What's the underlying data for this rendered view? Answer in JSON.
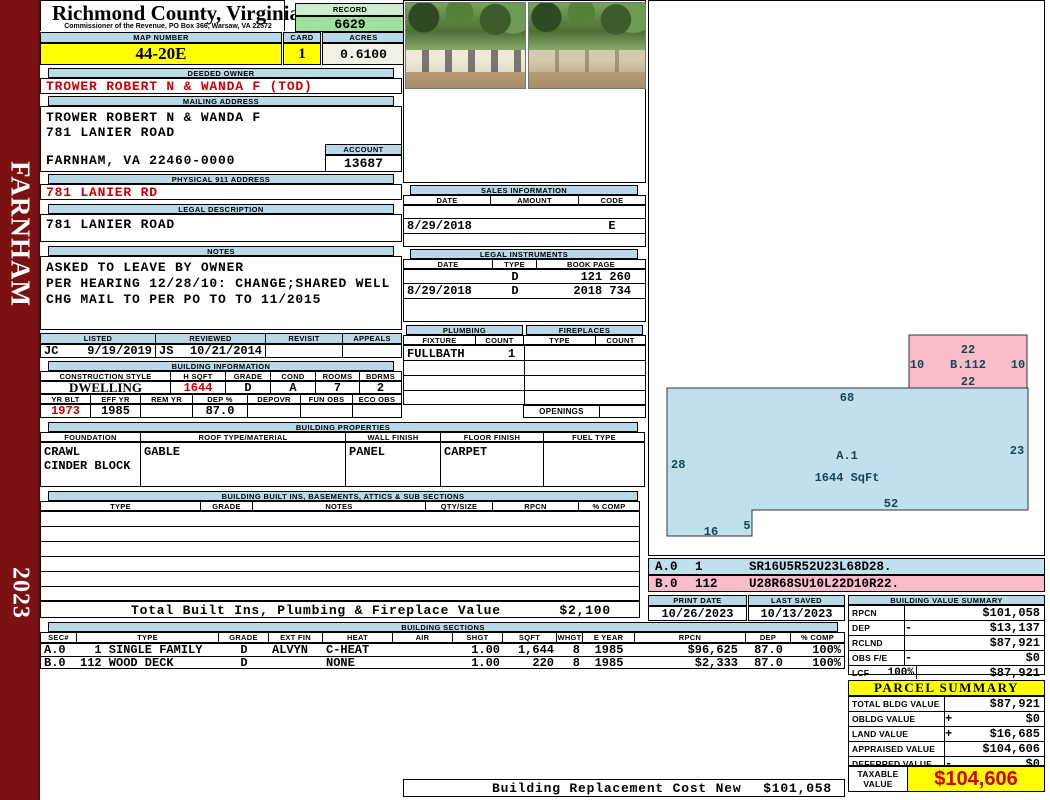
{
  "colors": {
    "blue": "#b9d9e8",
    "yellow": "#ffff00",
    "green": "#9fe09f",
    "green_light": "#cdeccd",
    "maroon": "#7c1113",
    "pink": "#f9bdc9",
    "sketch_blue": "#bfe0ec",
    "red": "#cc0000",
    "cream": "#f1f0e2"
  },
  "sidebar": {
    "district": "FARNHAM",
    "year": "2023"
  },
  "header": {
    "county": "Richmond County, Virginia",
    "subtitle": "Commissioner of the Revenue, PO Box 366, Warsaw, VA 22572",
    "record_label": "RECORD",
    "record_value": "6629",
    "map_label": "MAP NUMBER",
    "map_value": "44-20E",
    "card_label": "CARD",
    "card_value": "1",
    "acres_label": "ACRES",
    "acres_value": "0.6100"
  },
  "owner": {
    "label": "DEEDED OWNER",
    "value": "TROWER ROBERT N & WANDA F (TOD)"
  },
  "mailing": {
    "label": "MAILING ADDRESS",
    "line1": "TROWER ROBERT N & WANDA F",
    "line2": "781 LANIER ROAD",
    "line3": "FARNHAM, VA 22460-0000",
    "account_label": "ACCOUNT",
    "account_value": "13687"
  },
  "physical": {
    "label": "PHYSICAL 911 ADDRESS",
    "value": "781 LANIER RD"
  },
  "legal": {
    "label": "LEGAL DESCRIPTION",
    "value": "781 LANIER ROAD"
  },
  "notes": {
    "label": "NOTES",
    "line1": "ASKED TO LEAVE BY OWNER",
    "line2": "PER HEARING 12/28/10: CHANGE;SHARED WELL",
    "line3": "CHG MAIL TO PER PO TO TO 11/2015"
  },
  "review": {
    "listed_label": "LISTED",
    "reviewed_label": "REVIEWED",
    "revisit_label": "REVISIT",
    "appeals_label": "APPEALS",
    "listed_by": "JC",
    "listed_date": "9/19/2019",
    "reviewed_by": "JS",
    "reviewed_date": "10/21/2014"
  },
  "building_info": {
    "label": "BUILDING INFORMATION",
    "h1": [
      "CONSTRUCTION STYLE",
      "H SQFT",
      "GRADE",
      "COND",
      "ROOMS",
      "BDRMS"
    ],
    "v1": {
      "style": "DWELLING",
      "hsqft": "1644",
      "grade": "D",
      "cond": "A",
      "rooms": "7",
      "bdrms": "2"
    },
    "h2": [
      "YR BLT",
      "EFF YR",
      "REM YR",
      "DEP %",
      "DEPOVR",
      "FUN OBS",
      "ECO OBS"
    ],
    "v2": {
      "yrblt": "1973",
      "effyr": "1985",
      "remyr": "",
      "dep": "87.0",
      "depovr": "",
      "funobs": "",
      "ecoobs": ""
    }
  },
  "building_props": {
    "label": "BUILDING PROPERTIES",
    "h": [
      "FOUNDATION",
      "ROOF TYPE/MATERIAL",
      "WALL FINISH",
      "FLOOR FINISH",
      "FUEL TYPE"
    ],
    "foundation1": "CRAWL",
    "foundation2": "CINDER BLOCK",
    "roof": "GABLE",
    "wall": "PANEL",
    "floor": "CARPET",
    "fuel": ""
  },
  "built_ins": {
    "label": "BUILDING BUILT INS, BASEMENTS, ATTICS & SUB SECTIONS",
    "h": [
      "TYPE",
      "GRADE",
      "NOTES",
      "QTY/SIZE",
      "RPCN",
      "% COMP"
    ],
    "total_label": "Total Built Ins, Plumbing & Fireplace Value",
    "total_value": "$2,100"
  },
  "sales": {
    "label": "SALES INFORMATION",
    "h": [
      "DATE",
      "AMOUNT",
      "CODE"
    ],
    "rows": [
      {
        "date": "",
        "amount": "",
        "code": ""
      },
      {
        "date": "8/29/2018",
        "amount": "",
        "code": "E"
      },
      {
        "date": "",
        "amount": "",
        "code": ""
      }
    ]
  },
  "instruments": {
    "label": "LEGAL INSTRUMENTS",
    "h": [
      "DATE",
      "TYPE",
      "BOOK PAGE"
    ],
    "rows": [
      {
        "date": "",
        "type": "D",
        "book": "121 260"
      },
      {
        "date": "8/29/2018",
        "type": "D",
        "book": "2018 734"
      }
    ]
  },
  "plumbing": {
    "label": "PLUMBING",
    "h": [
      "FIXTURE",
      "COUNT"
    ],
    "fixture": "FULLBATH",
    "count": "1"
  },
  "fireplaces": {
    "label": "FIREPLACES",
    "h": [
      "TYPE",
      "COUNT"
    ],
    "openings_label": "OPENINGS"
  },
  "sketch": {
    "a": {
      "name": "A.1",
      "sqft": "1644 SqFt",
      "top": "68",
      "left": "28",
      "right": "23",
      "bottom": "52",
      "step": "5",
      "bottom_left": "16"
    },
    "b": {
      "name": "B.112",
      "top": "22",
      "left": "10",
      "right": "10",
      "bottom": "22"
    },
    "codes": [
      {
        "sec": "A.0",
        "num": "1",
        "code": "SR16U5R52U23L68D28."
      },
      {
        "sec": "B.0",
        "num": "112",
        "code": "U28R68SU10L22D10R22."
      }
    ]
  },
  "print_info": {
    "print_label": "PRINT DATE",
    "print_date": "10/26/2023",
    "saved_label": "LAST SAVED",
    "saved_date": "10/13/2023"
  },
  "value_summary": {
    "label": "BUILDING VALUE SUMMARY",
    "rows": [
      {
        "k": "RPCN",
        "sign": "",
        "v": "$101,058"
      },
      {
        "k": "DEP",
        "sign": "-",
        "v": "$13,137"
      },
      {
        "k": "RCLND",
        "sign": "",
        "v": "$87,921"
      },
      {
        "k": "OBS F/E",
        "sign": "-",
        "v": "$0"
      },
      {
        "k": "LCF",
        "pct": "100%",
        "sign": "",
        "v": "$87,921"
      }
    ]
  },
  "sections": {
    "label": "BUILDING SECTIONS",
    "h": [
      "SEC#",
      "TYPE",
      "GRADE",
      "EXT FIN",
      "HEAT",
      "AIR",
      "SHGT",
      "SQFT",
      "WHGT",
      "E YEAR",
      "RPCN",
      "DEP",
      "% COMP"
    ],
    "rows": [
      {
        "sec": "A.0",
        "type": "  1 SINGLE FAMILY",
        "grade": "D",
        "ext": "ALVYN",
        "heat": "C-HEAT",
        "air": "",
        "shgt": "1.00",
        "sqft": "1,644",
        "whgt": "8",
        "eyear": "1985",
        "rpcn": "$96,625",
        "dep": "87.0",
        "comp": "100%"
      },
      {
        "sec": "B.0",
        "type": "112 WOOD DECK",
        "grade": "D",
        "ext": "",
        "heat": "NONE",
        "air": "",
        "shgt": "1.00",
        "sqft": "220",
        "whgt": "8",
        "eyear": "1985",
        "rpcn": "$2,333",
        "dep": "87.0",
        "comp": "100%"
      }
    ]
  },
  "parcel": {
    "label": "PARCEL SUMMARY",
    "rows": [
      {
        "k": "TOTAL BLDG VALUE",
        "sign": "",
        "v": "$87,921"
      },
      {
        "k": "OBLDG VALUE",
        "sign": "+",
        "v": "$0"
      },
      {
        "k": "LAND VALUE",
        "sign": "+",
        "v": "$16,685"
      },
      {
        "k": "APPRAISED VALUE",
        "sign": "",
        "v": "$104,606"
      },
      {
        "k": "DEFERRED VALUE",
        "sign": "-",
        "v": "$0"
      }
    ],
    "taxable_label": "TAXABLE VALUE",
    "taxable_value": "$104,606"
  },
  "footer": {
    "label": "Building Replacement Cost New",
    "value": "$101,058"
  }
}
